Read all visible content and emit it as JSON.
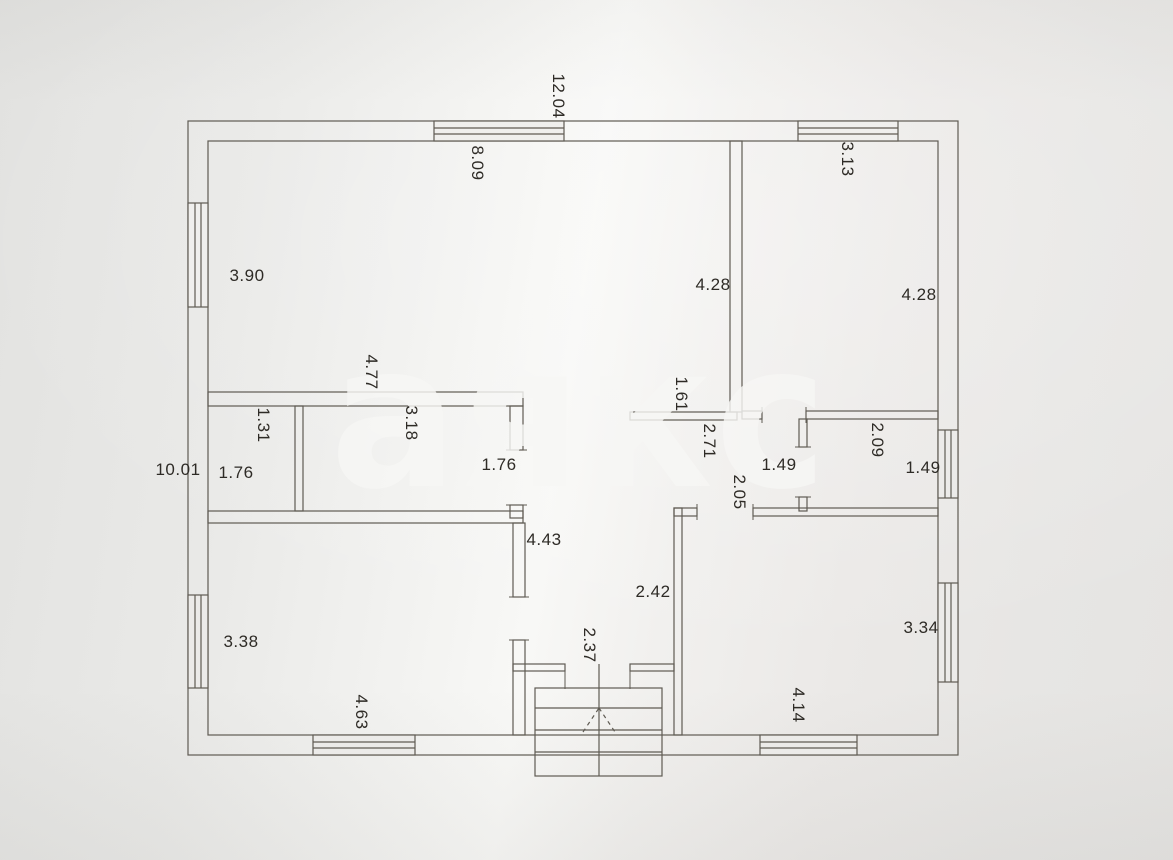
{
  "document": {
    "kind": "scanned floor plan",
    "units": "meters"
  },
  "watermark": {
    "text": "аякс"
  },
  "dimensions": [
    {
      "text": "12.04",
      "x": 558,
      "y": 96,
      "orientation": "vertical"
    },
    {
      "text": "8.09",
      "x": 477,
      "y": 163,
      "orientation": "vertical"
    },
    {
      "text": "3.13",
      "x": 847,
      "y": 159,
      "orientation": "vertical"
    },
    {
      "text": "3.90",
      "x": 247,
      "y": 276,
      "orientation": "horizontal"
    },
    {
      "text": "4.28",
      "x": 713,
      "y": 285,
      "orientation": "horizontal"
    },
    {
      "text": "4.28",
      "x": 919,
      "y": 295,
      "orientation": "horizontal"
    },
    {
      "text": "4.77",
      "x": 371,
      "y": 372,
      "orientation": "vertical"
    },
    {
      "text": "1.61",
      "x": 681,
      "y": 394,
      "orientation": "vertical"
    },
    {
      "text": "1.31",
      "x": 263,
      "y": 425,
      "orientation": "vertical"
    },
    {
      "text": "3.18",
      "x": 411,
      "y": 423,
      "orientation": "vertical"
    },
    {
      "text": "2.71",
      "x": 709,
      "y": 441,
      "orientation": "vertical"
    },
    {
      "text": "2.09",
      "x": 877,
      "y": 440,
      "orientation": "vertical"
    },
    {
      "text": "10.01",
      "x": 178,
      "y": 470,
      "orientation": "horizontal"
    },
    {
      "text": "1.76",
      "x": 236,
      "y": 473,
      "orientation": "horizontal"
    },
    {
      "text": "1.76",
      "x": 499,
      "y": 465,
      "orientation": "horizontal"
    },
    {
      "text": "1.49",
      "x": 779,
      "y": 465,
      "orientation": "horizontal"
    },
    {
      "text": "1.49",
      "x": 923,
      "y": 468,
      "orientation": "horizontal"
    },
    {
      "text": "2.05",
      "x": 739,
      "y": 492,
      "orientation": "vertical"
    },
    {
      "text": "4.43",
      "x": 544,
      "y": 540,
      "orientation": "horizontal"
    },
    {
      "text": "2.42",
      "x": 653,
      "y": 592,
      "orientation": "horizontal"
    },
    {
      "text": "3.38",
      "x": 241,
      "y": 642,
      "orientation": "horizontal"
    },
    {
      "text": "2.37",
      "x": 589,
      "y": 645,
      "orientation": "vertical"
    },
    {
      "text": "3.34",
      "x": 921,
      "y": 628,
      "orientation": "horizontal"
    },
    {
      "text": "4.63",
      "x": 361,
      "y": 712,
      "orientation": "vertical"
    },
    {
      "text": "4.14",
      "x": 798,
      "y": 705,
      "orientation": "vertical"
    }
  ],
  "colors": {
    "paper": "#ebeae8",
    "line": "#5f5b53",
    "label_text": "#2e2b26",
    "watermark": "#f7f7f5"
  }
}
